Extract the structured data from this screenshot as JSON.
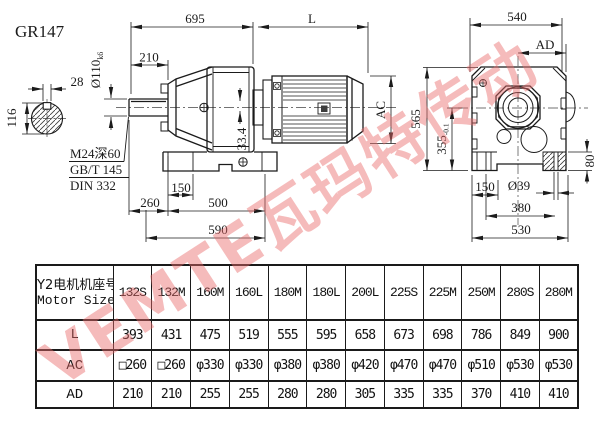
{
  "title": "GR147",
  "watermark": "VEMTE瓦玛特传动",
  "drawing": {
    "dims": {
      "top_width": "695",
      "motor_length": "L",
      "side_width": "540",
      "ad": "AD",
      "shaft_len": "210",
      "shaft_dia": "Ø110",
      "shaft_dia_tol": "k6",
      "key_width": "28",
      "section_height": "116",
      "note_line1": "M24深60",
      "note_line2": "GB/T 145",
      "note_line3": "DIN 332",
      "key_pos": "33.4",
      "ac": "AC",
      "total_height": "565",
      "axis_height": "355",
      "axis_height_tol": "-0.1",
      "foot_height": "80",
      "foot_hole_front": "150",
      "front_overhang": "260",
      "front_span": "500",
      "front_total": "590",
      "foot_hole_side": "150",
      "hole_dia": "Ø39",
      "side_span": "380",
      "side_total": "530"
    }
  },
  "table": {
    "header_cn": "Y2电机机座号",
    "header_en": "Motor Size",
    "columns": [
      "132S",
      "132M",
      "160M",
      "160L",
      "180M",
      "180L",
      "200L",
      "225S",
      "225M",
      "250M",
      "280S",
      "280M"
    ],
    "rows": [
      {
        "key": "L",
        "label": "L",
        "values": [
          "393",
          "431",
          "475",
          "519",
          "555",
          "595",
          "658",
          "673",
          "698",
          "786",
          "849",
          "900"
        ]
      },
      {
        "key": "AC",
        "label": "AC",
        "values": [
          "□260",
          "□260",
          "φ330",
          "φ330",
          "φ380",
          "φ380",
          "φ420",
          "φ470",
          "φ470",
          "φ510",
          "φ530",
          "φ530"
        ]
      },
      {
        "key": "AD",
        "label": "AD",
        "values": [
          "210",
          "210",
          "255",
          "255",
          "280",
          "280",
          "305",
          "335",
          "335",
          "370",
          "410",
          "410"
        ]
      }
    ]
  }
}
